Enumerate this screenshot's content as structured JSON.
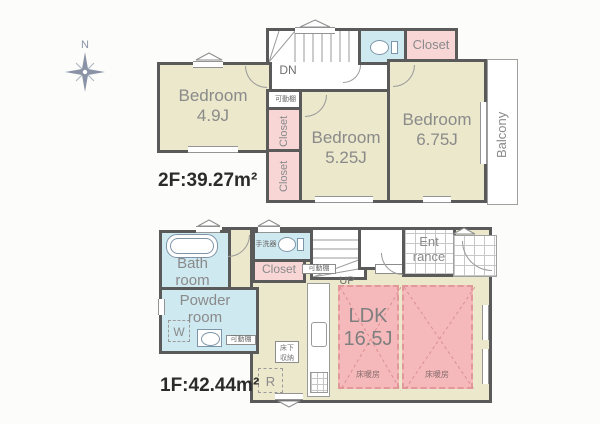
{
  "palette": {
    "wall": "#5a5a5a",
    "room_fill": "#ebe8cb",
    "wet_area_fill": "#cfe9f1",
    "closet_fill": "#f8d6d6",
    "floor_heating_fill": "#f5b9bb",
    "label_gray": "#8a8a8a",
    "area_text": "#2b2b2b"
  },
  "compass": {
    "north": "N"
  },
  "floor2": {
    "area": "2F:39.27m²",
    "bedroom_small": {
      "line1": "Bedroom",
      "line2": "4.9J"
    },
    "bedroom_mid": {
      "line1": "Bedroom",
      "line2": "5.25J"
    },
    "bedroom_large": {
      "line1": "Bedroom",
      "line2": "6.75J"
    },
    "closet_hall": "Closet",
    "closet_upper": "Closet",
    "closet_lower": "Closet",
    "shelf": "可動棚",
    "stairs_label": "DN",
    "balcony": "Balcony"
  },
  "floor1": {
    "area": "1F:42.44m²",
    "bath": {
      "line1": "Bath",
      "line2": "room"
    },
    "powder": {
      "line1": "Powder",
      "line2": "room"
    },
    "washer": "W",
    "hand_basin": "手洗器",
    "closet": "Closet",
    "shelf_hall": "可動棚",
    "shelf_powder": "可動棚",
    "stairs_label": "UP",
    "entrance": {
      "line1": "Ent",
      "line2": "rance"
    },
    "ldk": {
      "line1": "LDK",
      "line2": "16.5J"
    },
    "floor_heating_left": "床暖房",
    "floor_heating_right": "床暖房",
    "underfloor": {
      "line1": "床下",
      "line2": "収納"
    },
    "fridge": "R"
  }
}
